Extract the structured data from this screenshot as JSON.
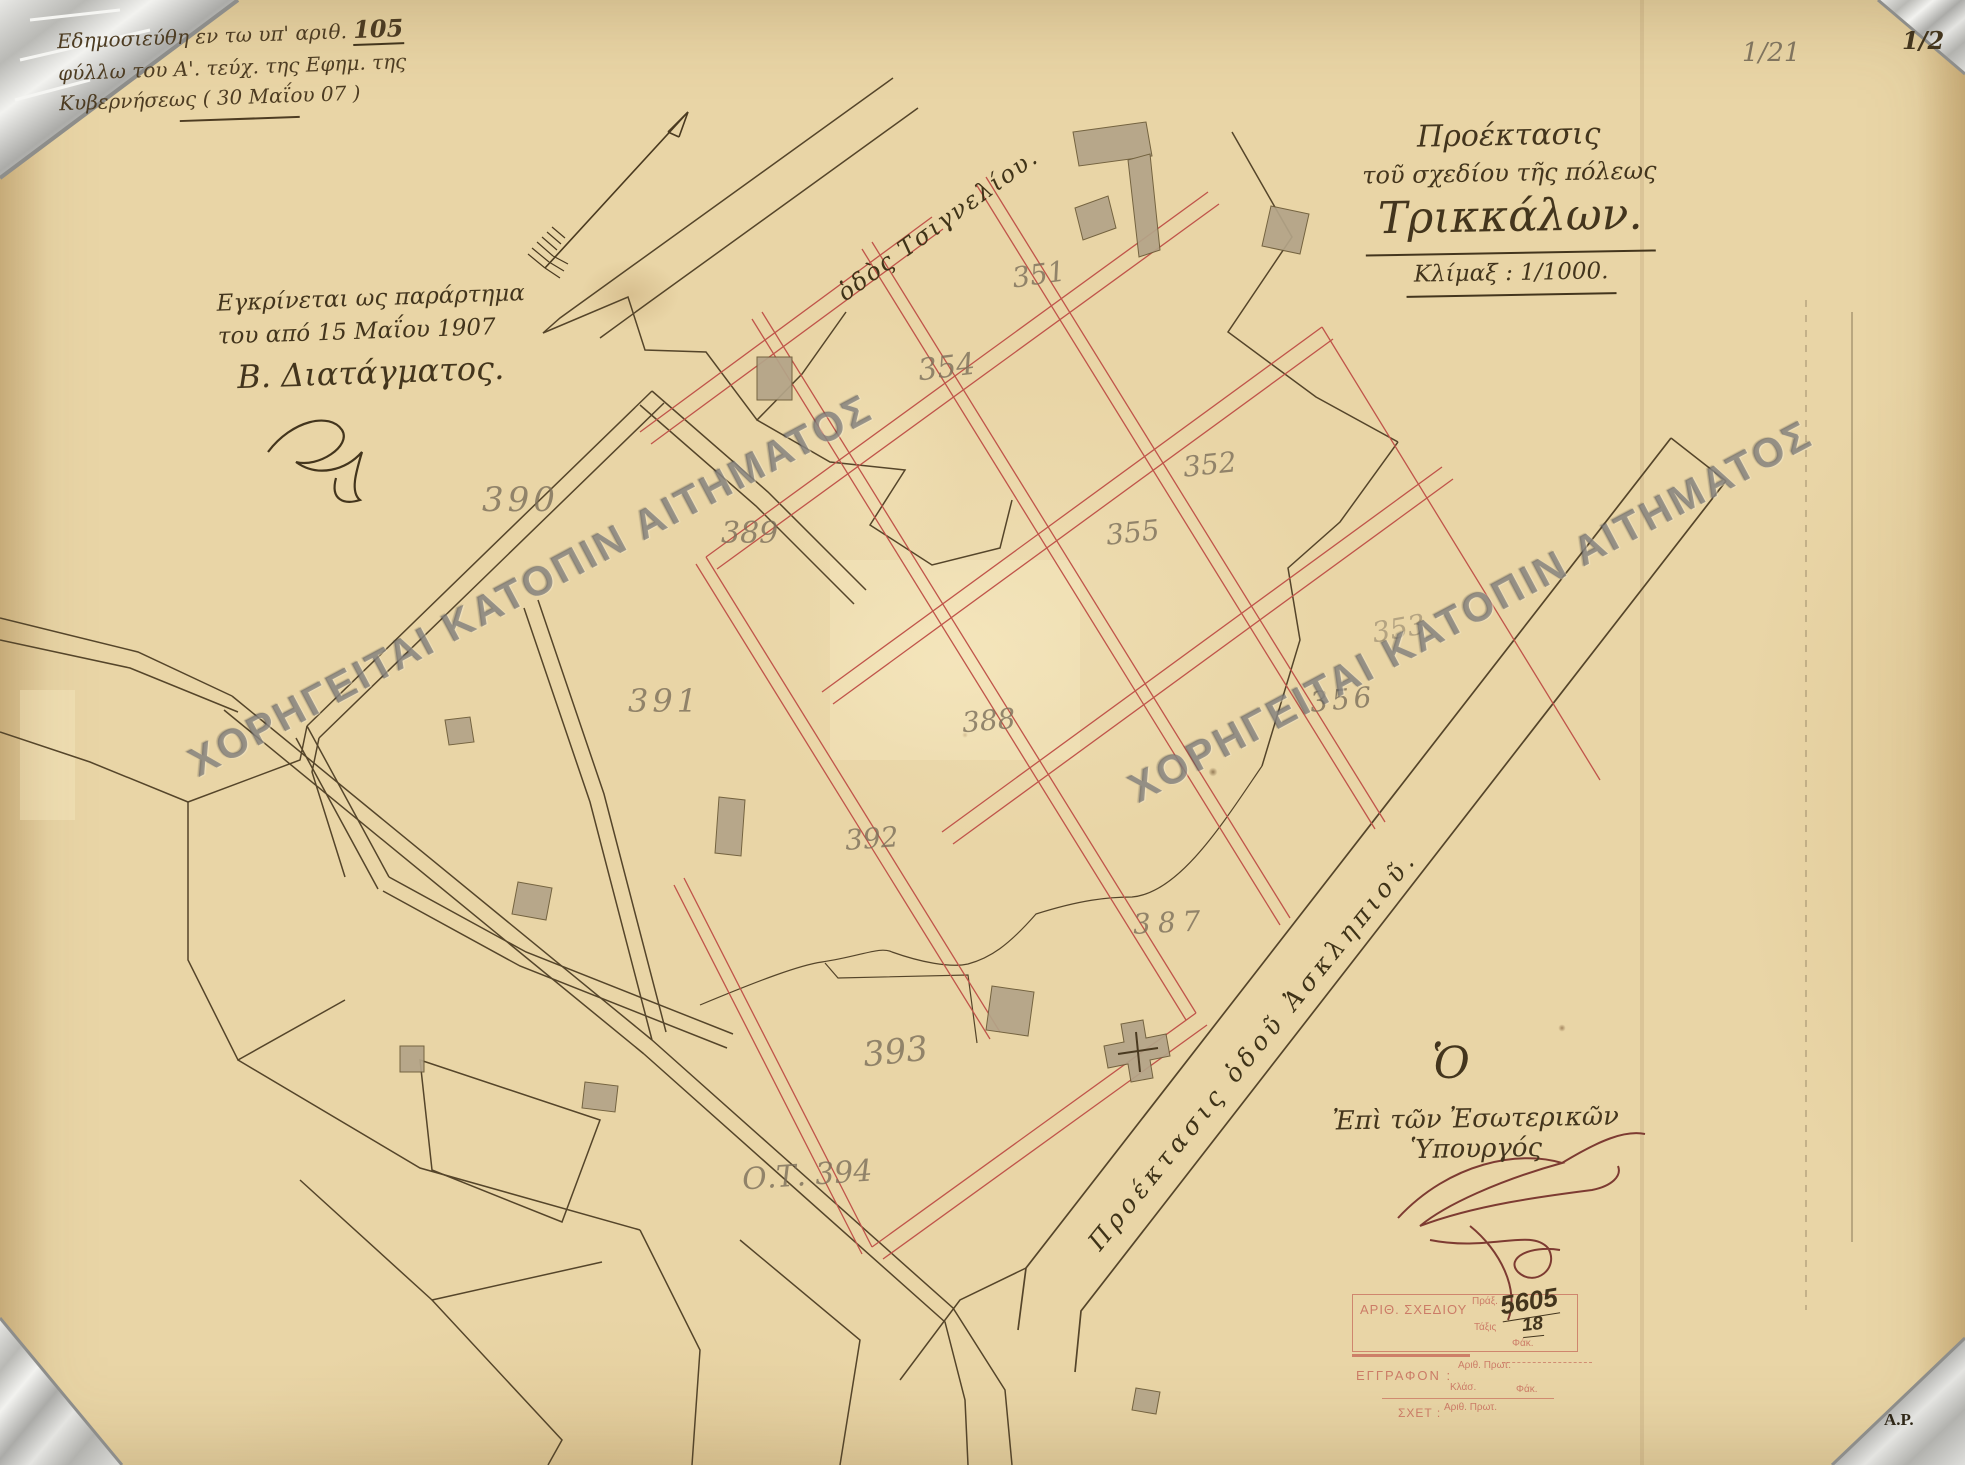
{
  "doc": {
    "note": {
      "l1a": "Εδημοσιεύθη εν τω υπ' αριθ.",
      "l1b": "105",
      "l2": "φύλλω του Α'. τεύχ. της Εφημ. της",
      "l3": "Κυβερνήσεως ( 30 Μαΐου 07 )"
    },
    "approval": {
      "l1": "Εγκρίνεται ως παράρτημα",
      "l2": "του από 15 Μαΐου 1907",
      "l3": "Β. Διατάγματος."
    },
    "title": {
      "l1": "Προέκτασις",
      "l2": "τοῦ σχεδίου τῆς πόλεως",
      "l3": "Τρικκάλων.",
      "scale": "Κλίμαξ : 1/1000."
    },
    "streets": {
      "north": "ὁδὸς Τσιγνελίου.",
      "asklipiou": "Προέκτασις ὁδοῦ Ἀσκληπιοῦ."
    },
    "minister": {
      "o": "Ὁ",
      "line": "Ἐπὶ τῶν Ἐσωτερικῶν Ὑπουργός"
    },
    "marks": {
      "folio_pencil": "1/21",
      "folio_ink": "1/2",
      "initials": "Α.Ρ."
    },
    "stamp": {
      "row1_label": "ΑΡΙΘ. ΣΧΕΔΙΟΥ",
      "prax": "Πράξ.",
      "plan_no": "5605",
      "taxis": "Τάξις",
      "taxis_val": "18",
      "fak1": "Φάκ.",
      "eggrafon": "ΕΓΓΡΑΦΟΝ :",
      "ar_prot1": "Αριθ. Πρωτ.",
      "klas": "Κλάσ.",
      "fak2": "Φάκ.",
      "sxet": "ΣΧΕΤ :",
      "ar_prot2": "Αριθ. Πρωτ."
    },
    "watermark": "ΧΟΡΗΓΕΙΤΑΙ ΚΑΤΟΠΙΝ ΑΙΤΗΜΑΤΟΣ"
  },
  "map": {
    "blocks": [
      "351",
      "352",
      "353",
      "354",
      "355",
      "356",
      "387",
      "388",
      "389",
      "390",
      "391",
      "392",
      "393",
      "Ο.Τ. 394"
    ]
  },
  "colors": {
    "paper": "#e9d5a6",
    "ink": "#43351d",
    "plan_red": "#c0544a",
    "pencil_grey": "#7a6e5a",
    "stamp_red": "#ba4640",
    "watermark_grey": "#626267"
  }
}
